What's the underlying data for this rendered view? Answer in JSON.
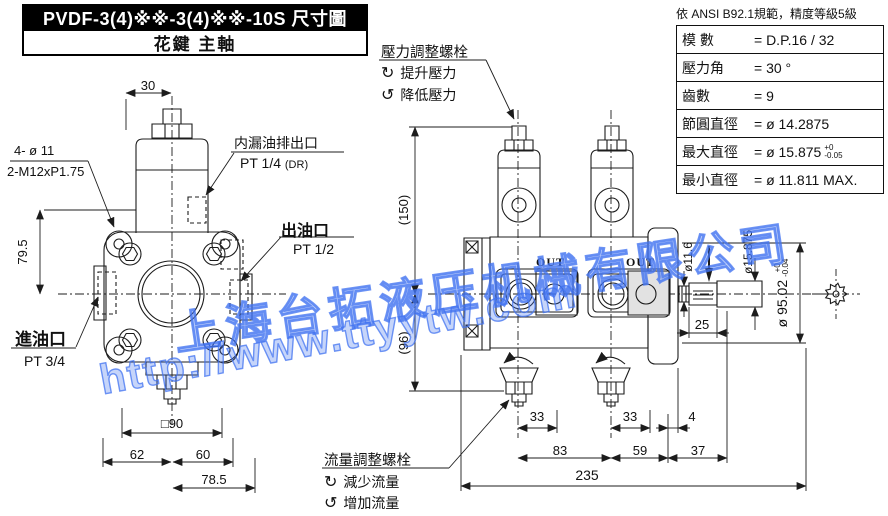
{
  "title": {
    "line1": "PVDF-3(4)※※-3(4)※※-10S 尺寸圖",
    "line2": "花鍵 主軸"
  },
  "spec_table": {
    "header": "依 ANSI B92.1規範，精度等級5級",
    "rows": [
      {
        "label": "模 數",
        "value": "= D.P.16 / 32"
      },
      {
        "label": "壓力角",
        "value": "= 30 °"
      },
      {
        "label": "齒數",
        "value": "= 9"
      },
      {
        "label": "節圓直徑",
        "value": "= ø 14.2875"
      },
      {
        "label": "最大直徑",
        "value": "= ø 15.875",
        "tol_plus": "+0",
        "tol_minus": "-0.05"
      },
      {
        "label": "最小直徑",
        "value": "= ø 11.811 MAX."
      }
    ]
  },
  "pressure_adjust": {
    "title": "壓力調整螺栓",
    "cw_icon": "↻",
    "cw_label": "提升壓力",
    "ccw_icon": "↺",
    "ccw_label": "降低壓力"
  },
  "flow_adjust": {
    "title": "流量調整螺栓",
    "cw_icon": "↻",
    "cw_label": "減少流量",
    "ccw_icon": "↺",
    "ccw_label": "增加流量"
  },
  "front_view": {
    "bolt_label_line1": "4- ø 11",
    "bolt_label_line2": "2-M12xP1.75",
    "drain_label": "内漏油排出口",
    "drain_spec": "PT 1/4",
    "drain_suffix": "(DR)",
    "outlet_label": "出油口",
    "outlet_spec": "PT 1/2",
    "inlet_label": "進油口",
    "inlet_spec": "PT 3/4",
    "dims": {
      "top_width": "30",
      "height": "79.5",
      "square": "□90",
      "left": "62",
      "right": "60",
      "offset": "78.5"
    }
  },
  "side_view": {
    "out_label": "OUT",
    "dims": {
      "h_upper": "(150)",
      "h_lower": "(96)",
      "pitch1": "33",
      "pitch2": "33",
      "gap": "4",
      "span1": "83",
      "span2": "59",
      "span3": "37",
      "total": "235",
      "shaft_len": "25",
      "shaft_d1": "ø11.6",
      "shaft_d2": "ø15.875",
      "body_d": "ø 95.02",
      "body_tol_plus": "+0",
      "body_tol_minus": "-0.04"
    }
  },
  "watermark": {
    "line1": "上海台拓液压机械有限公司",
    "line2": "http://www.ttyytw.com",
    "color": "#4273f0"
  },
  "colors": {
    "line": "#1c1c1c",
    "background": "#ffffff"
  }
}
